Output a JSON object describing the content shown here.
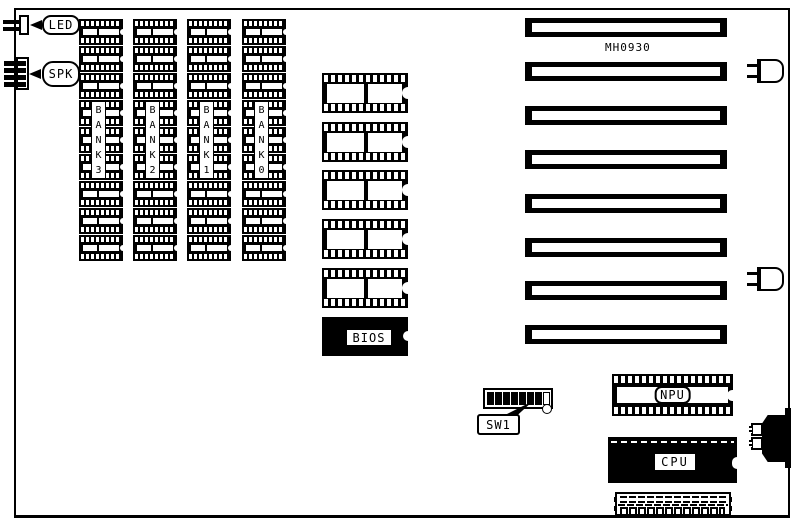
{
  "board": {
    "model_label": "MH0930",
    "ink": "#000000",
    "background": "#ffffff"
  },
  "connectors": {
    "led": {
      "label": "LED",
      "pins": 2
    },
    "spk": {
      "label": "SPK",
      "pins": 4
    },
    "keyboard": {
      "pins": 2
    }
  },
  "memory": {
    "chips_per_bank": 9,
    "banks": [
      {
        "label": "BANK3"
      },
      {
        "label": "BANK2"
      },
      {
        "label": "BANK1"
      },
      {
        "label": "BANK0"
      }
    ]
  },
  "rom": {
    "chip_count": 5,
    "bios_label": "BIOS"
  },
  "expansion_slots": {
    "count": 8
  },
  "sw1": {
    "label": "SW1",
    "positions": 8,
    "on_count": 7
  },
  "npu": {
    "label": "NPU"
  },
  "cpu": {
    "label": "CPU"
  },
  "power_connector": {
    "pin_count": 12,
    "hole_count": 12
  }
}
